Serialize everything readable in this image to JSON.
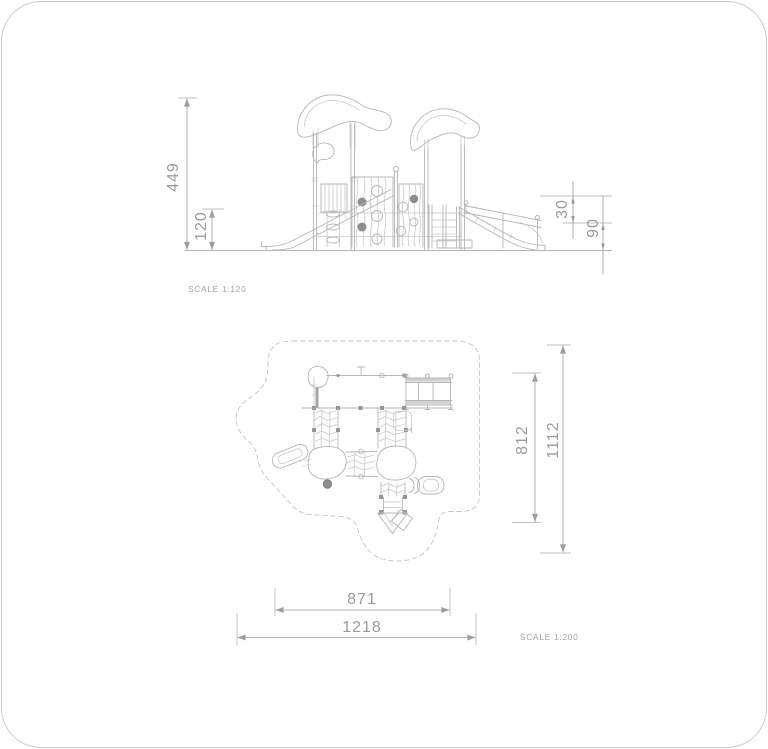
{
  "page": {
    "background": "#ffffff",
    "border_color": "#cccccc"
  },
  "colors": {
    "drawing_line": "#b6b6b6",
    "texture_line": "#c9c9c9",
    "dimension_line": "#9e9e9e",
    "text_gray": "#9b9b9b",
    "filled_marker": "#8e8e8e",
    "safety_zone_dash": "#c4c4c4"
  },
  "elevation": {
    "scale_label": "SCALE 1:120",
    "dimensions": {
      "total_height": "449",
      "platform_height": "120",
      "guardrail_offset": "30",
      "slide_exit_height": "90"
    }
  },
  "plan": {
    "scale_label": "SCALE 1:200",
    "dimensions": {
      "equipment_depth": "812",
      "safety_zone_depth": "1112",
      "equipment_width": "871",
      "safety_zone_width": "1218"
    }
  }
}
